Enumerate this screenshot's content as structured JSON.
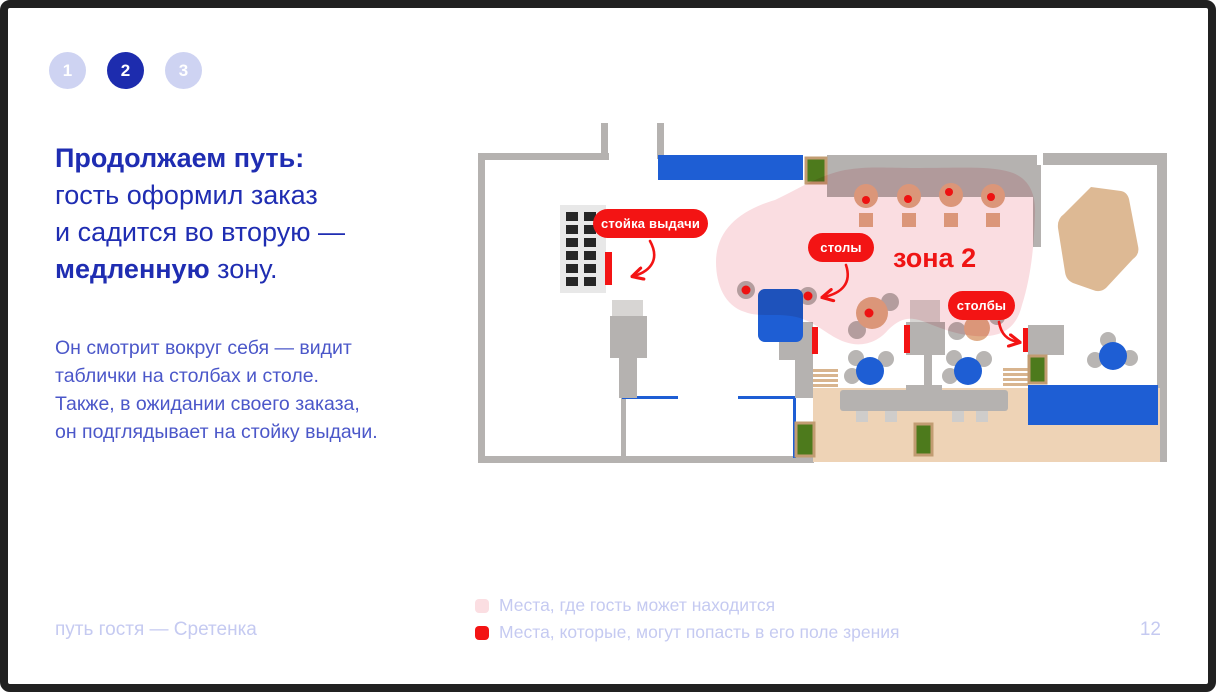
{
  "steps": [
    {
      "label": "1",
      "active": false
    },
    {
      "label": "2",
      "active": true
    },
    {
      "label": "3",
      "active": false
    }
  ],
  "headline": {
    "line1_bold": "Продолжаем путь:",
    "line2": "гость оформил заказ",
    "line3": "и садится во вторую —",
    "line4_bold": "медленную",
    "line4_rest": " зону."
  },
  "body": {
    "line1": "Он смотрит вокруг себя — видит",
    "line2": "таблички на столбах и столе.",
    "line3": "Также, в ожидании своего заказа,",
    "line4": "он подглядывает на стойку выдачи."
  },
  "plan": {
    "labels": {
      "pickup": "стойка выдачи",
      "tables": "столы",
      "zone": "зона 2",
      "pillars": "столбы"
    }
  },
  "legend": [
    {
      "swatch": "#fbdee2",
      "text": "Места, где гость может находится"
    },
    {
      "swatch": "#f31414",
      "text": "Места, которые, могут попасть в его поле зрения"
    }
  ],
  "footer": {
    "left": "путь гостя — Сретенка",
    "page": "12"
  },
  "colors": {
    "accent_red": "#f31414",
    "heading_blue": "#1f2db2",
    "body_blue": "#4b57c9",
    "muted_lavender": "#c5caf1",
    "step_active": "#1d2cae",
    "step_inactive": "#ced3f2",
    "wall_gray": "#b5b2b0",
    "furniture_blue": "#1e5ed4",
    "planter_green": "#4d7a1c",
    "wood_tan": "#e0ad89",
    "floor_tan": "#eed3b6",
    "zone_pink": "#fadde1"
  }
}
